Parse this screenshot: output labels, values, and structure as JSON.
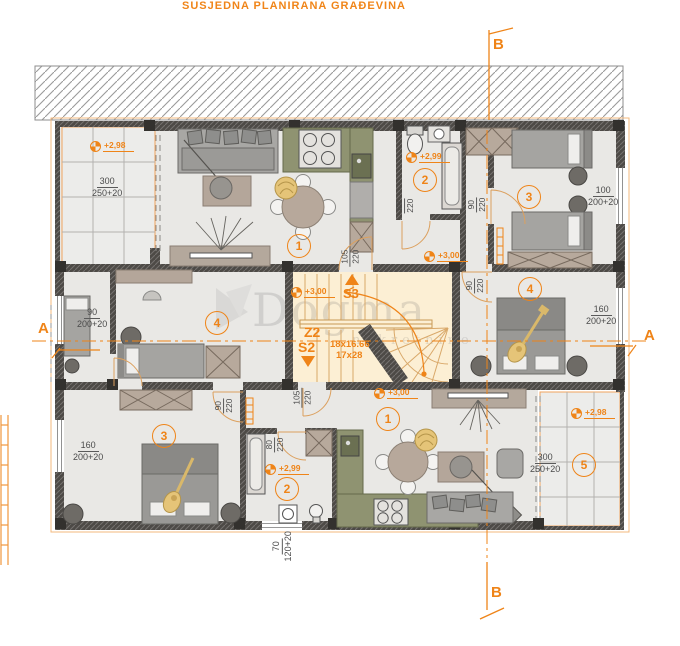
{
  "neighbor": {
    "label": "SUSJEDNA PLANIRANA GRAĐEVINA"
  },
  "watermark": {
    "name": "Dogma",
    "subtitle": "nekretnine"
  },
  "sections": {
    "b_top": "B",
    "b_bottom": "B",
    "a_left": "A",
    "a_right": "A"
  },
  "stairs": {
    "s3": "S3",
    "z2": "Z2",
    "s2": "S2",
    "steps1": "18x16.66",
    "steps2": "17x28"
  },
  "room_numbers": [
    {
      "n": "1"
    },
    {
      "n": "2"
    },
    {
      "n": "3"
    },
    {
      "n": "4"
    },
    {
      "n": "4"
    },
    {
      "n": "1"
    },
    {
      "n": "2"
    },
    {
      "n": "3"
    },
    {
      "n": "5"
    }
  ],
  "elevations": [
    {
      "v": "+2,98"
    },
    {
      "v": "+2,99"
    },
    {
      "v": "+3,00"
    },
    {
      "v": "+3,00"
    },
    {
      "v": "+3,00"
    },
    {
      "v": "+2,99"
    },
    {
      "v": "+2,98"
    }
  ],
  "dims": [
    {
      "num": "300",
      "den": "250+20"
    },
    {
      "num": "100",
      "den": "200+20"
    },
    {
      "num": "90",
      "den": "200+20"
    },
    {
      "num": "160",
      "den": "200+20"
    },
    {
      "num": "160",
      "den": "200+20"
    },
    {
      "num": "300",
      "den": "250+20"
    },
    {
      "num": "70",
      "den": "120+20"
    }
  ],
  "door_dims": [
    {
      "num": "105",
      "den": "220"
    },
    {
      "num": "80",
      "den": "220"
    },
    {
      "num": "90",
      "den": "220"
    },
    {
      "num": "90",
      "den": "220"
    },
    {
      "num": "105",
      "den": "220"
    },
    {
      "num": "80",
      "den": "220"
    },
    {
      "num": "90",
      "den": "220"
    }
  ],
  "colors": {
    "accent_orange": "#ef8418",
    "wall": "#4d4a46",
    "floor": "#e9e8e5",
    "stair_floor": "#fcefd4",
    "kitchen": "#8f9371",
    "furniture_taupe": "#b7a99c",
    "plant_yellow": "#e5c478"
  }
}
